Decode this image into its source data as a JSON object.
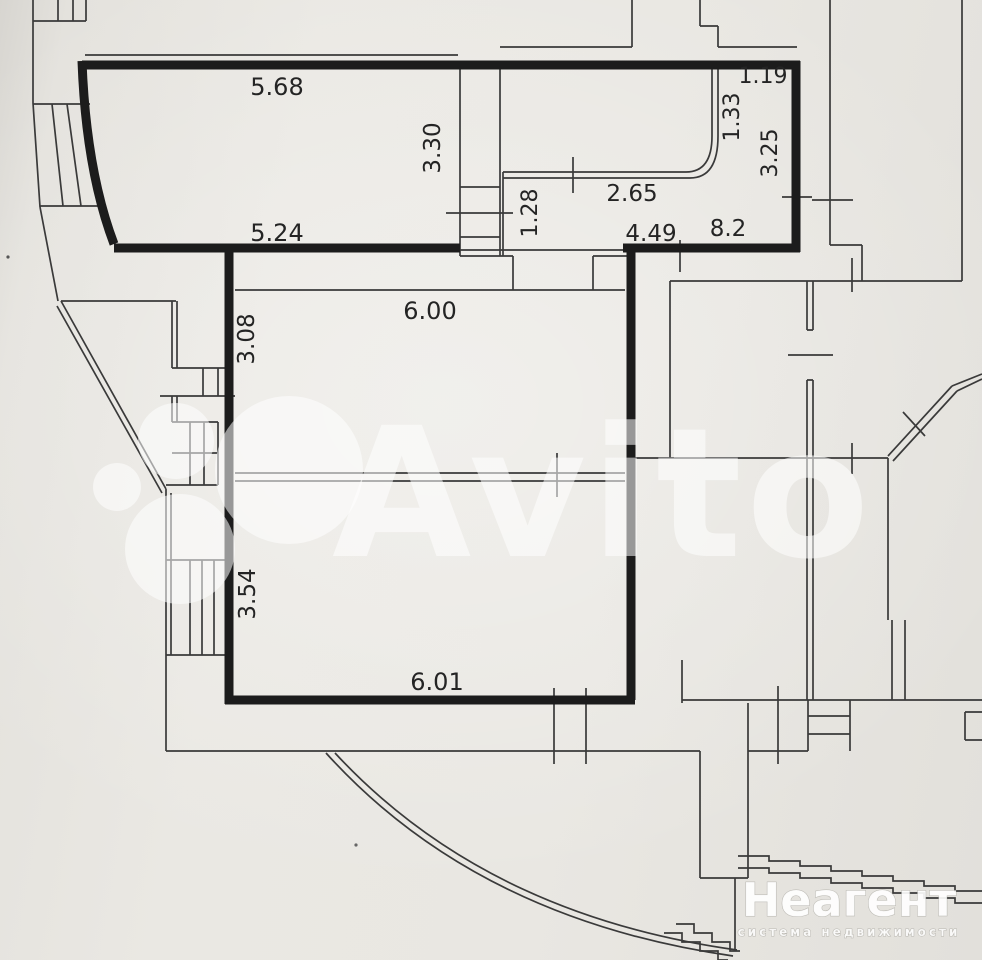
{
  "document": {
    "kind": "apartment floor plan scan",
    "units": "meters"
  },
  "colors": {
    "paper": "#e9e7e2",
    "wall_bold": "#1c1c1c",
    "line_thin": "#3a3a3a",
    "label_text": "#242424",
    "watermark": "rgba(255,255,255,0.55)"
  },
  "watermarks": {
    "avito": {
      "text": "Avito"
    },
    "neagent": {
      "title": "Неагент",
      "subtitle": "система недвижимости"
    }
  },
  "dimensions": {
    "room1_top_width": "5.68",
    "room1_height": "3.30",
    "room1_bottom_width": "5.24",
    "niche_width": "1.19",
    "niche_height": "1.33",
    "room2_height": "3.25",
    "room2_inner_width": "2.65",
    "duct_height": "1.28",
    "room2_bottom_width": "4.49",
    "room2_area": "8.2",
    "room3_width": "6.00",
    "room3_height": "3.08",
    "room4_height": "3.54",
    "room4_width": "6.01"
  }
}
